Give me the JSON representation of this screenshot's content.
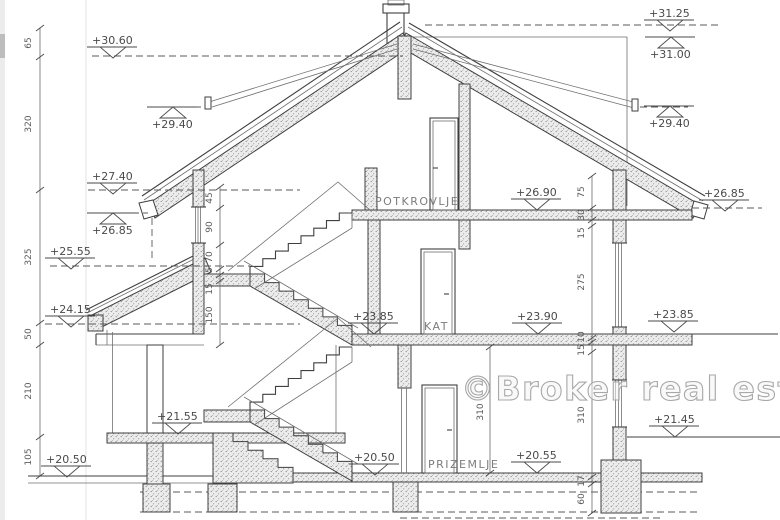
{
  "watermark": {
    "text": "©Broker real estate"
  },
  "rooms": {
    "attic": "POTKROVLJE",
    "first_floor": "KAT",
    "ground_floor": "PRIZEMLJE"
  },
  "markers": [
    {
      "label": "+31.25"
    },
    {
      "label": "+31.00"
    },
    {
      "label": "+30.60"
    },
    {
      "label": "+29.40"
    },
    {
      "label": "+29.40"
    },
    {
      "label": "+27.40"
    },
    {
      "label": "+26.85"
    },
    {
      "label": "+26.90"
    },
    {
      "label": "+26.85"
    },
    {
      "label": "+25.55"
    },
    {
      "label": "+24.15"
    },
    {
      "label": "+23.85"
    },
    {
      "label": "+23.90"
    },
    {
      "label": "+23.85"
    },
    {
      "label": "+21.55"
    },
    {
      "label": "+21.45"
    },
    {
      "label": "+20.50"
    },
    {
      "label": "+20.50"
    },
    {
      "label": "+20.55"
    }
  ],
  "dims": {
    "left": [
      "65",
      "320",
      "325",
      "50",
      "210",
      "105"
    ],
    "stair": [
      "45",
      "90",
      "70",
      "5",
      "15",
      "150"
    ],
    "right": [
      "75",
      "30",
      "15",
      "275",
      "10",
      "15",
      "310",
      "17",
      "60"
    ],
    "center": [
      "310"
    ]
  },
  "colors": {
    "line": "#3f3f3f",
    "dim_text": "#5a5a5a",
    "room_label": "#7d7d7d",
    "watermark_stroke": "#a8a8a8"
  }
}
